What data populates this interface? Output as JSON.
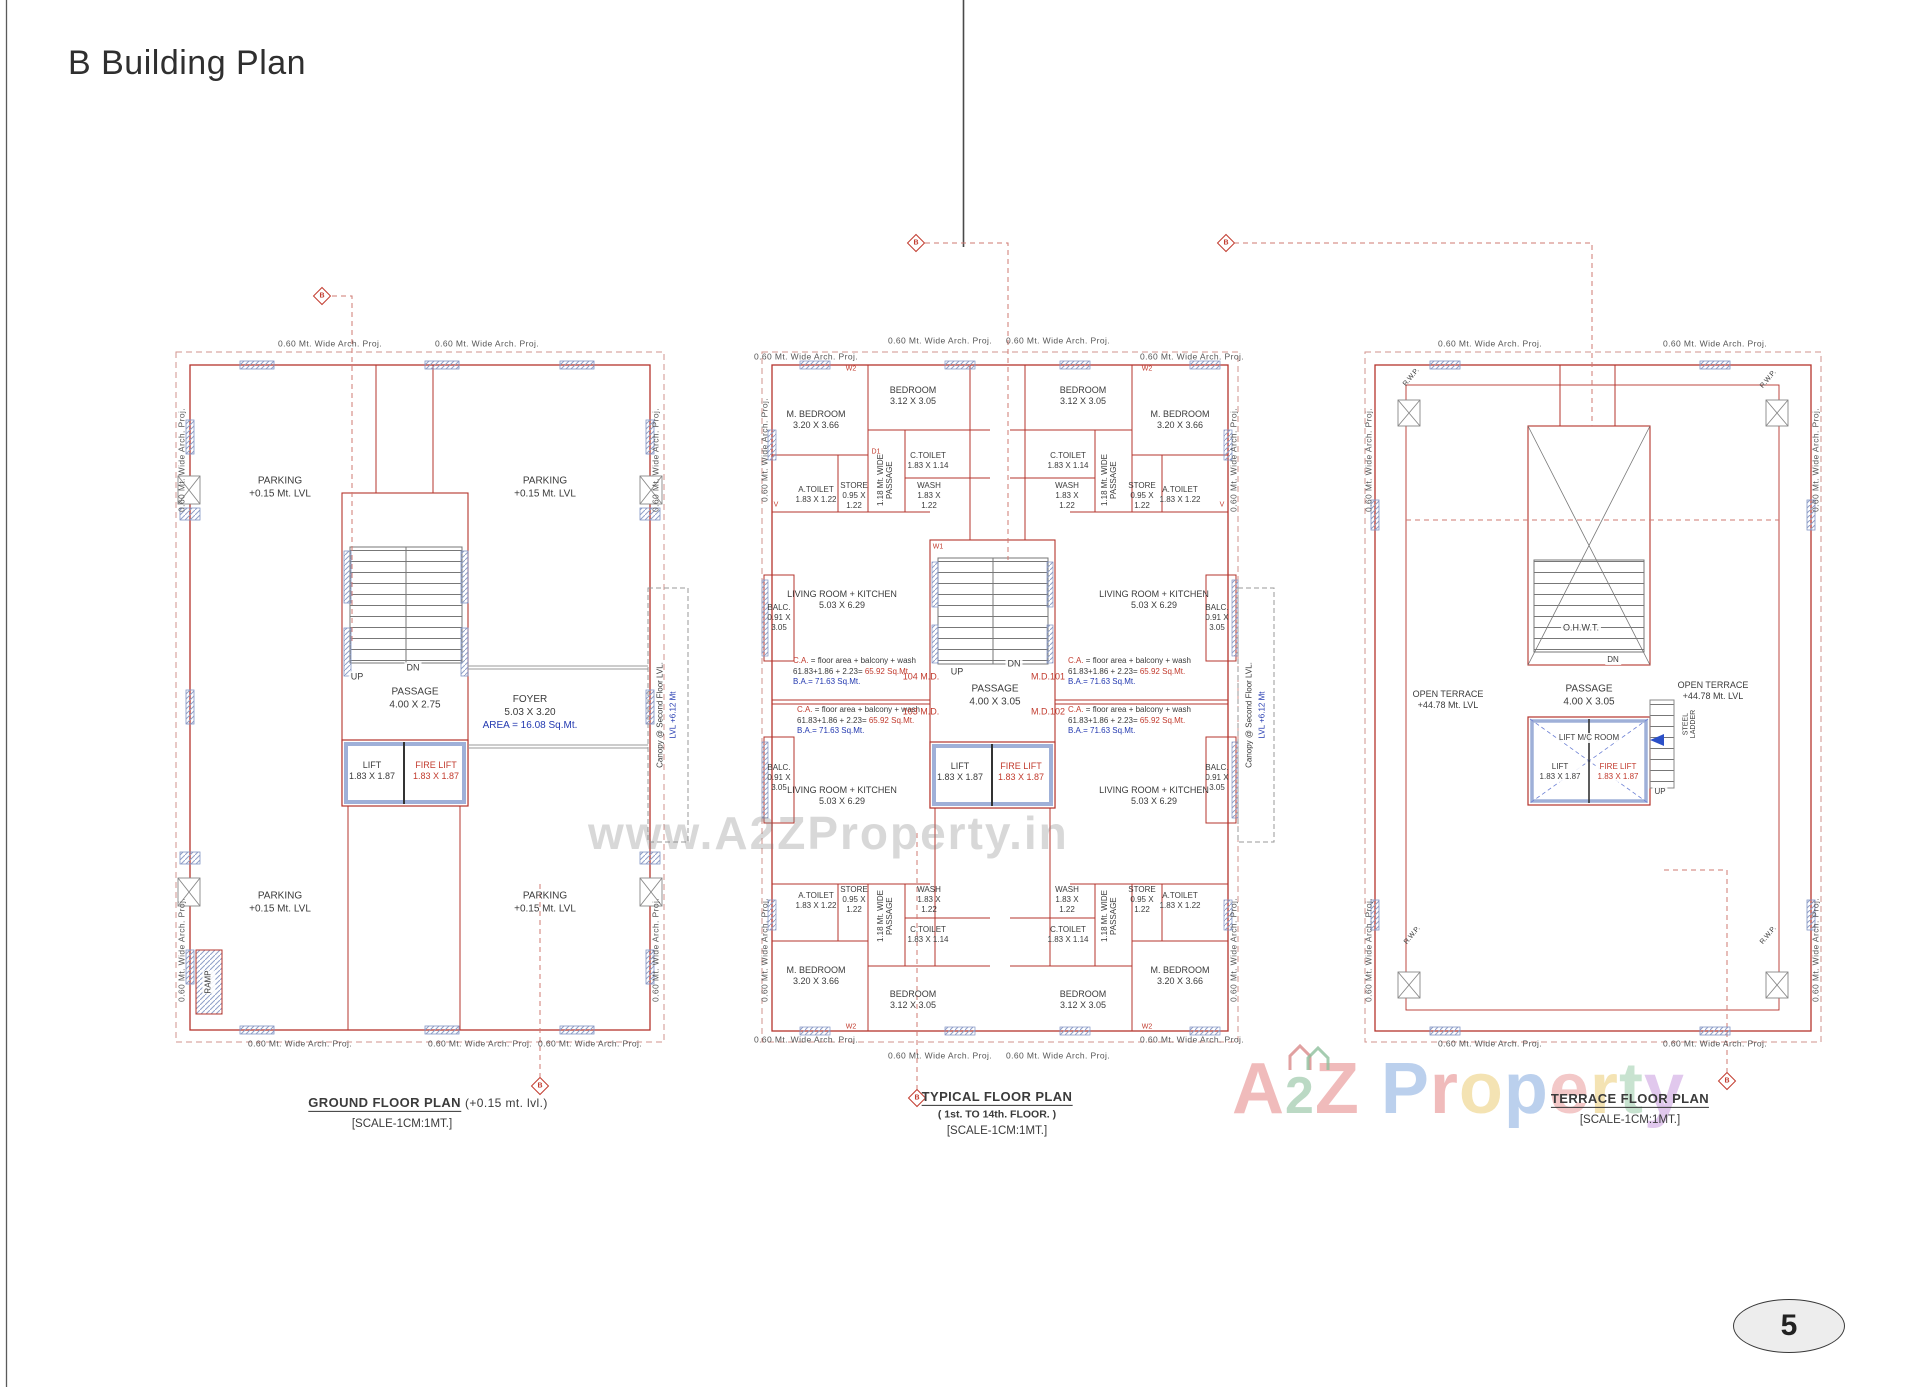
{
  "page": {
    "title": "B Building Plan",
    "page_number": "5"
  },
  "watermark": {
    "center": "www.A2ZProperty.in",
    "logo": [
      {
        "ch": "A",
        "color": "#eda8a8"
      },
      {
        "ch": "2",
        "color": "#a9cfb4"
      },
      {
        "ch": "Z",
        "color": "#eda8a8"
      },
      {
        "ch": " ",
        "color": "#ffffff"
      },
      {
        "ch": "P",
        "color": "#a9c3e9"
      },
      {
        "ch": "r",
        "color": "#eda8a8"
      },
      {
        "ch": "o",
        "color": "#f2dc9e"
      },
      {
        "ch": "p",
        "color": "#a9c3e9"
      },
      {
        "ch": "e",
        "color": "#f0b9b9"
      },
      {
        "ch": "r",
        "color": "#f2dc9e"
      },
      {
        "ch": "t",
        "color": "#b9dcc3"
      },
      {
        "ch": "y",
        "color": "#d9b9e9"
      }
    ]
  },
  "shared": {
    "arch_proj": "0.60 Mt.  Wide  Arch.  Proj.",
    "canopy_line1": "Canopy @ Second Floor LVL.",
    "canopy_line2": "LVL +6.12 Mt",
    "lift": "LIFT\n1.83 X 1.87",
    "fire_lift": "FIRE LIFT\n1.83 X 1.87",
    "up": "UP",
    "dn": "DN",
    "scale": "[SCALE-1CM:1MT.]",
    "section_marker": "B"
  },
  "ground": {
    "caption": "GROUND FLOOR PLAN",
    "caption_suffix": "(+0.15 mt. lvl.)",
    "parking": "PARKING\n+0.15 Mt. LVL",
    "passage": "PASSAGE\n4.00 X 2.75",
    "foyer_name": "FOYER",
    "foyer_dims": "5.03 X 3.20",
    "foyer_area": "AREA = 16.08 Sq.Mt.",
    "ramp": "RAMP"
  },
  "typical": {
    "caption": "TYPICAL FLOOR PLAN",
    "caption_sub": "( 1st. TO 14th. FLOOR. )",
    "passage": "PASSAGE\n4.00 X 3.05",
    "rooms": {
      "m_bedroom": "M. BEDROOM\n3.20 X 3.66",
      "bedroom": "BEDROOM\n3.12 X 3.05",
      "a_toilet": "A.TOILET\n1.83 X 1.22",
      "store": "STORE\n0.95 X\n1.22",
      "c_toilet": "C.TOILET\n1.83 X 1.14",
      "wash": "WASH\n1.83 X\n1.22",
      "wide_passage": "1.18 Mt. WIDE\nPASSAGE",
      "living": "LIVING ROOM + KITCHEN\n5.03 X 6.29",
      "balc": "BALC.\n0.91 X\n3.05"
    },
    "ca": {
      "label": "C.A.",
      "formula": "= floor area + balcony + wash",
      "calc": "61.83+1.86 + 2.23=",
      "area_red": "65.92 Sq.Mt.",
      "ba": "B.A.= 71.63 Sq.Mt."
    },
    "flats": {
      "f104": "104 M.D.",
      "f103": "103 M.D.",
      "f101": "M.D.101",
      "f102": "M.D.102"
    }
  },
  "terrace": {
    "caption": "TERRACE FLOOR PLAN",
    "open_terrace": "OPEN TERRACE\n+44.78 Mt. LVL",
    "ohwt": "O.H.W.T.",
    "passage": "PASSAGE\n4.00 X 3.05",
    "lift_mc_room": "LIFT M/C ROOM",
    "steel_ladder": "STEEL\nLADDER",
    "rwp": "R.W.P."
  },
  "tags": {
    "w1": "W1",
    "w2": "W2",
    "d1": "D1",
    "v": "V"
  },
  "colors": {
    "wall_red": "#b5342c",
    "dashed_red": "#cf7a72",
    "column_blue": "#8fa0c8",
    "text_red": "#c23b2e",
    "text_blue": "#2339b0",
    "stair_gray": "#777777"
  }
}
